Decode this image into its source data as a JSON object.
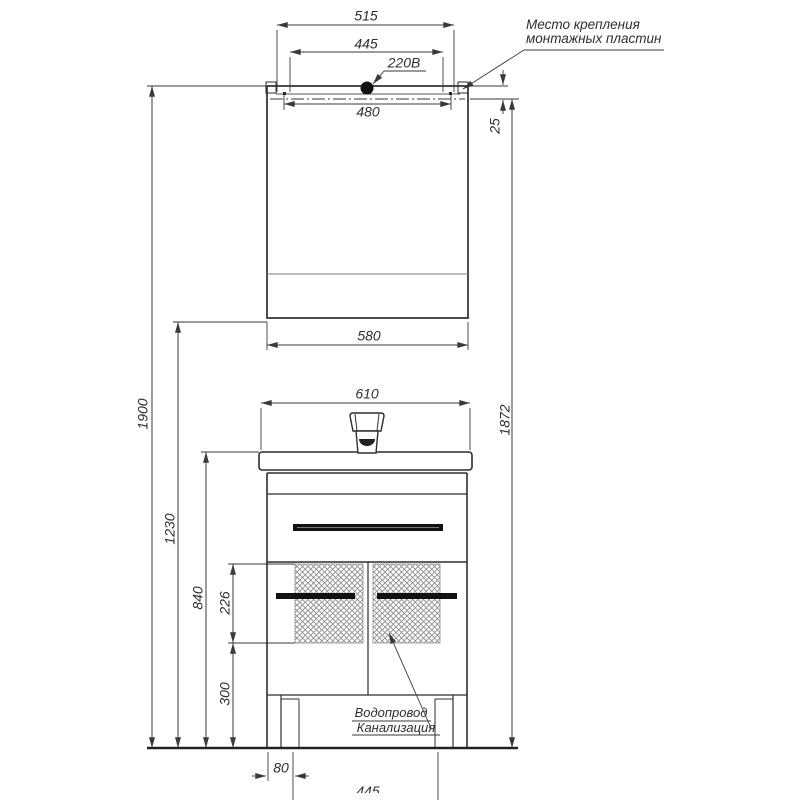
{
  "labels": {
    "mounting_plates_line1": "Место крепления",
    "mounting_plates_line2": "монтажных пластин",
    "power_outlet": "220В",
    "water_supply": "Водопровод",
    "sewerage": "Канализация"
  },
  "dims": {
    "mount_plate_outer_width": "515",
    "mount_plate_inner_width": "445",
    "mount_hole_spacing": "480",
    "mount_line_offset": "25",
    "mirror_width": "580",
    "washbasin_width": "610",
    "overall_height": "1900",
    "mirror_bottom_height": "1230",
    "washbasin_height": "840",
    "service_zone_height": "226",
    "bottom_clearance": "300",
    "mount_line_height": "1872",
    "service_zone_left_offset": "80",
    "service_zone_width": "445"
  },
  "colors": {
    "object_line": "#2e2e2e",
    "dim_line": "#3a3a3a",
    "thin_line": "#777777",
    "hatch_line": "#8f8f8f",
    "background": "#ffffff"
  }
}
